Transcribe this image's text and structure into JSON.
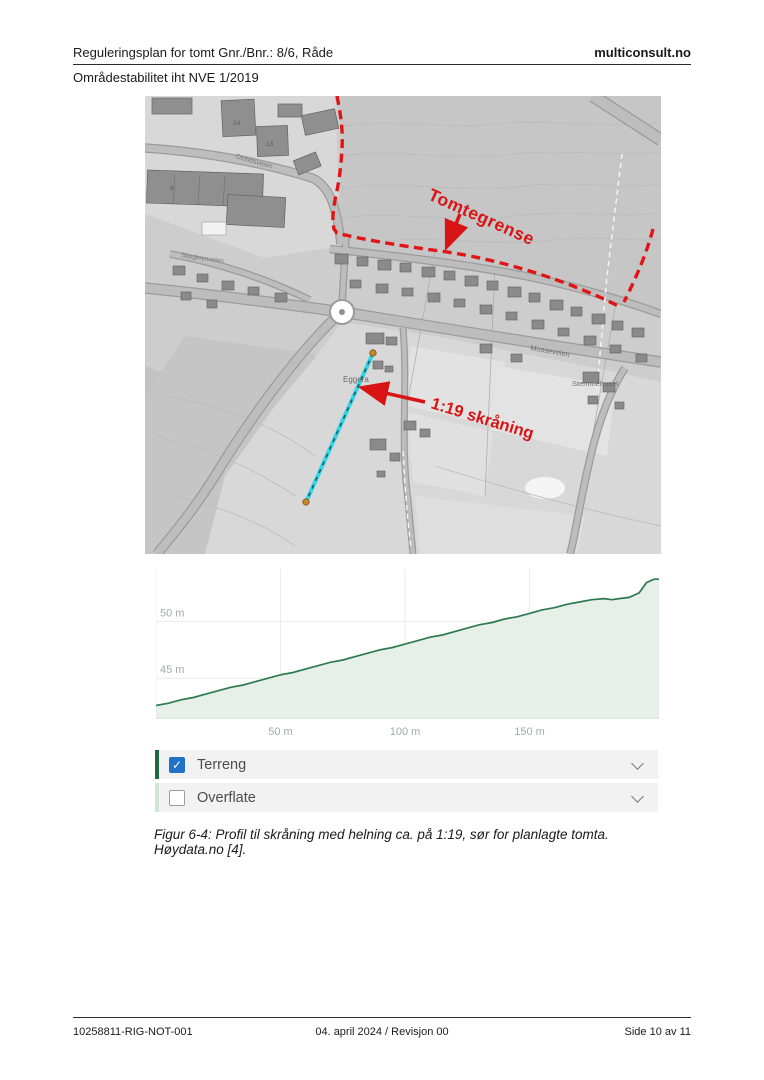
{
  "page": {
    "header": {
      "title": "Reguleringsplan for tomt Gnr./Bnr.: 8/6, Råde",
      "brand": "multiconsult.no",
      "subtitle": "Områdestabilitet iht NVE 1/2019"
    },
    "caption": "Figur 6-4: Profil til skråning med helning ca. på 1:19, sør for planlagte tomta. Høydata.no [4].",
    "footer": {
      "doc_id": "10258811-RIG-NOT-001",
      "date_revision": "04. april 2024 / Revisjon 00",
      "page_info": "Side 10 av 11"
    }
  },
  "map": {
    "annotations": {
      "boundary_label": "Tomtegrense",
      "slope_label": "1:19 skråning"
    },
    "labels": {
      "place_eggera": "Eggera",
      "road_mosseveien": "Mosseveien",
      "place_stemmehuset": "Stemmehuset",
      "road_oldtidsveien": "Oldtidsveien",
      "road_skogbrynveien": "Skogbrynveien",
      "num_6": "6",
      "num_13": "13",
      "num_14": "14"
    },
    "colors": {
      "annotation_red": "#d81414",
      "boundary_red": "#e01616",
      "profile_cyan": "#35d4e4",
      "endpoint_orange": "#c8872f"
    }
  },
  "profile_panel": {
    "layers": [
      {
        "label": "Terreng",
        "checked": true
      },
      {
        "label": "Overflate",
        "checked": false
      }
    ]
  },
  "chart_data": {
    "type": "area",
    "title": "",
    "xlabel": "",
    "ylabel": "",
    "x": [
      0,
      5,
      10,
      15,
      20,
      25,
      30,
      35,
      40,
      45,
      50,
      55,
      60,
      65,
      70,
      75,
      80,
      85,
      90,
      95,
      100,
      105,
      110,
      115,
      120,
      125,
      130,
      135,
      140,
      145,
      150,
      155,
      160,
      165,
      170,
      175,
      180,
      183,
      186,
      190,
      194,
      197,
      200,
      202
    ],
    "elevation_m": [
      42.6,
      42.8,
      43.1,
      43.3,
      43.6,
      43.9,
      44.2,
      44.4,
      44.7,
      45.0,
      45.3,
      45.5,
      45.8,
      46.1,
      46.4,
      46.6,
      46.9,
      47.2,
      47.5,
      47.7,
      48.0,
      48.3,
      48.6,
      48.8,
      49.1,
      49.4,
      49.7,
      49.9,
      50.2,
      50.4,
      50.7,
      51.0,
      51.2,
      51.5,
      51.7,
      51.9,
      52.0,
      51.9,
      52.0,
      52.1,
      52.5,
      53.4,
      53.7,
      53.7
    ],
    "xlim": [
      0,
      202
    ],
    "ylim": [
      41.5,
      54.6
    ],
    "xticks": [
      50,
      100,
      150
    ],
    "xtick_labels": [
      "50 m",
      "100 m",
      "150 m"
    ],
    "yticks": [
      45,
      50
    ],
    "ytick_labels": [
      "45 m",
      "50 m"
    ],
    "grid": true,
    "legend": "none",
    "colors": {
      "line": "#2c7a50",
      "fill": "#e7efe9",
      "grid": "#ebebeb",
      "axis": "#ccd4d0",
      "tick_text": "#a3aaa8"
    }
  }
}
